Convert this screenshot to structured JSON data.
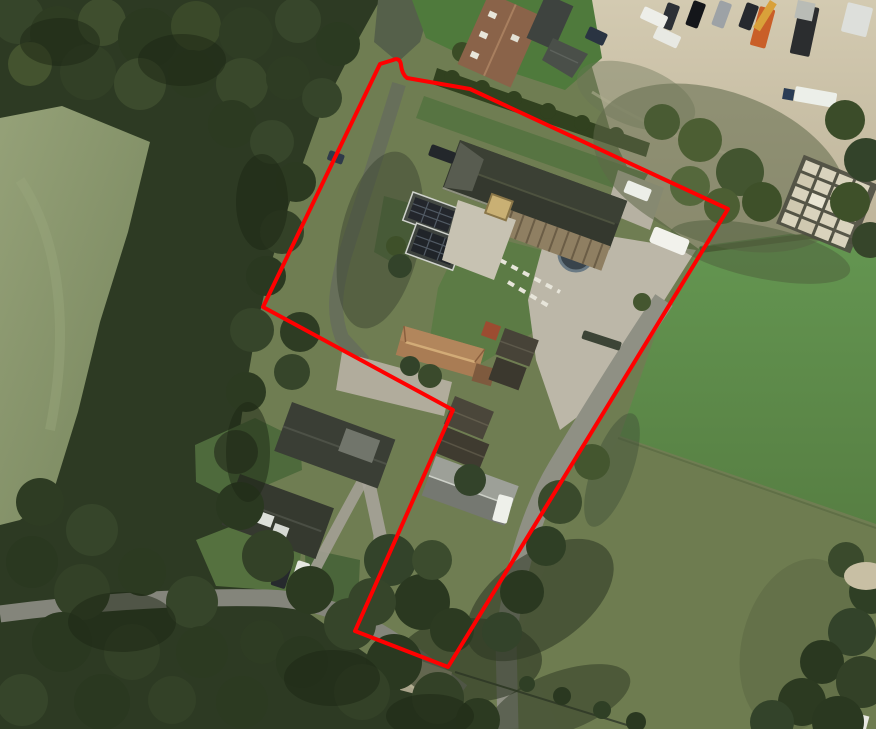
{
  "meta": {
    "view": "aerial-photo",
    "description": "Top-down aerial photograph of a rural farm property with woods, fields, farm buildings and a red cadastral parcel boundary overlay"
  },
  "overlay": {
    "parcel_boundary": {
      "color": "#ff0000",
      "stroke_width": 4,
      "path": "M 380,64 L 393,60 Q 400,57 401,65 Q 402,74 407,78 L 470,89 L 728,209 L 448,667 L 355,631 L 453,410 L 263,307 Z"
    }
  },
  "palette": {
    "base_field": "#6f7d52",
    "woods": "#2d3a23",
    "field_left": "#87936a",
    "field_bright": "#5d8c48",
    "field_olive": "#6e7c50",
    "sand_yard": "#cbc2a8",
    "paving": "#bcb7a8",
    "road": "#8f9084",
    "barn_roof": "#34382e",
    "orange_roof": "#a97c54",
    "dark_roof": "#3a3e35",
    "gray_shed_roof": "#9da098",
    "vehicle_white": "#f2f2ec"
  },
  "features": [
    {
      "name": "woods-left",
      "label": "dense tree belt along left and bottom"
    },
    {
      "name": "field-left",
      "label": "pale green pasture, far left"
    },
    {
      "name": "sand-yard",
      "label": "sandy contractor yard, top right, with parked cars, crane truck and block stacks"
    },
    {
      "name": "barn",
      "label": "large dark-roofed barn in parcel centre"
    },
    {
      "name": "solar-house",
      "label": "outbuilding with solar panels west of barn"
    },
    {
      "name": "farmhouse",
      "label": "orange hip-roofed farmhouse mid parcel"
    },
    {
      "name": "gray-shed",
      "label": "gray gabled shed in southern parcel finger"
    },
    {
      "name": "neighbor-houses",
      "label": "two dark-roofed houses outside parcel, lower left"
    },
    {
      "name": "fields-right",
      "label": "bright and olive green pastures on the right"
    },
    {
      "name": "road",
      "label": "narrow lane running from bottom left junction up through the yard"
    }
  ]
}
